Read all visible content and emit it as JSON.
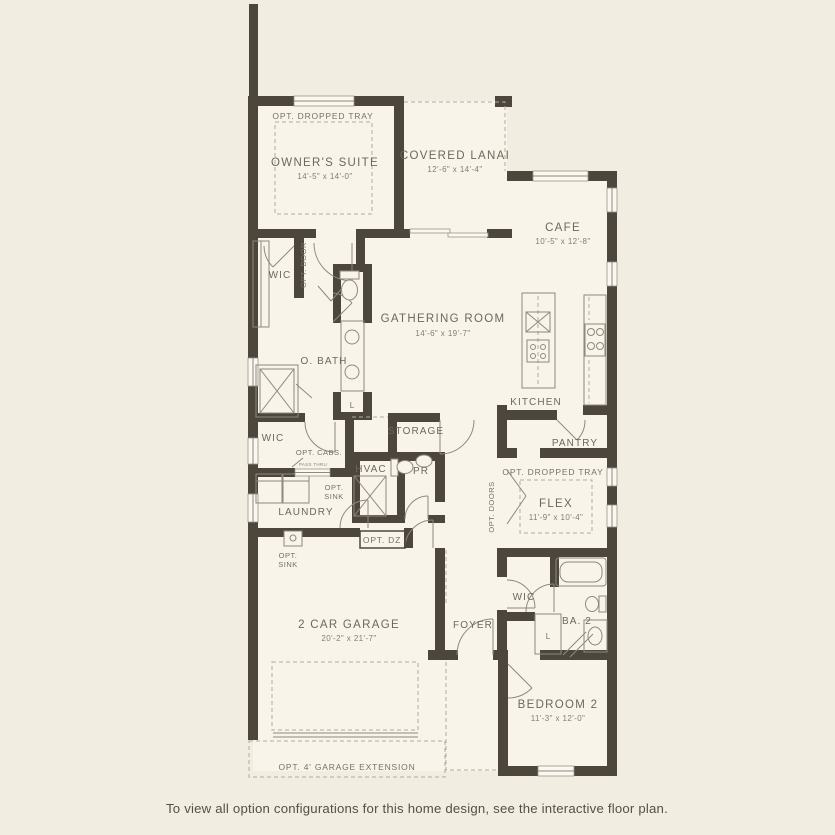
{
  "colors": {
    "background": "#f1ede1",
    "floor": "#f8f4e9",
    "wall": "#4d463c",
    "line": "#8f897c",
    "dashed": "#b3ab9b",
    "label": "#6e675c",
    "caption": "#55503f"
  },
  "caption": "To view all option configurations for this home design, see the interactive floor plan.",
  "rooms": {
    "owners_suite": {
      "name": "OWNER'S SUITE",
      "dims": "14'-5\" x 14'-0\""
    },
    "covered_lanai": {
      "name": "COVERED LANAI",
      "dims": "12'-6\" x 14'-4\""
    },
    "cafe": {
      "name": "CAFE",
      "dims": "10'-5\" x 12'-8\""
    },
    "gathering_room": {
      "name": "GATHERING ROOM",
      "dims": "14'-6\" x 19'-7\""
    },
    "kitchen": {
      "name": "KITCHEN"
    },
    "pantry": {
      "name": "PANTRY"
    },
    "owners_bath": {
      "name": "O. BATH"
    },
    "owners_wic": {
      "name": "WIC"
    },
    "hall_wic": {
      "name": "WIC"
    },
    "bed2_wic": {
      "name": "WIC"
    },
    "storage": {
      "name": "STORAGE"
    },
    "hvac": {
      "name": "HVAC"
    },
    "powder": {
      "name": "PR"
    },
    "laundry": {
      "name": "LAUNDRY"
    },
    "flex": {
      "name": "FLEX",
      "dims": "11'-9\" x 10'-4\""
    },
    "garage": {
      "name": "2 CAR GARAGE",
      "dims": "20'-2\" x 21'-7\""
    },
    "foyer": {
      "name": "FOYER"
    },
    "bath2": {
      "name": "BA. 2"
    },
    "bedroom2": {
      "name": "BEDROOM 2",
      "dims": "11'-3\" x 12'-0\""
    }
  },
  "labels": {
    "opt_dropped_tray_owners": "OPT. DROPPED TRAY",
    "opt_dropped_tray_flex": "OPT. DROPPED TRAY",
    "opt_door": "OPT. DOOR",
    "opt_doors": "OPT. DOORS",
    "opt_cabs": "OPT. CABS.",
    "pass_thru": "PASS THRU",
    "opt_sink_line1": "OPT.",
    "opt_sink_line2": "SINK",
    "opt_dz": "OPT. DZ",
    "opt_garage_extension": "OPT. 4' GARAGE EXTENSION",
    "linen": "L"
  }
}
